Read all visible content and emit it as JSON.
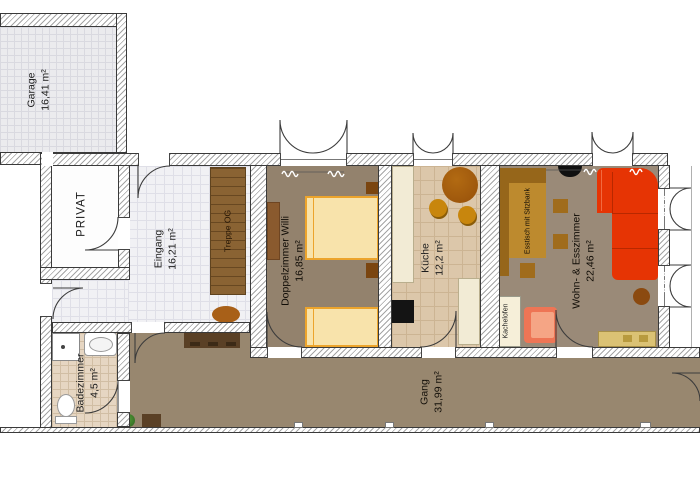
{
  "rooms": {
    "garage": {
      "name": "Garage",
      "area": "16,41 m²"
    },
    "privat": {
      "name": "PRIVAT",
      "area": ""
    },
    "eingang": {
      "name": "Eingang",
      "area": "16,21 m²"
    },
    "treppe_og": {
      "name": "Treppe OG",
      "area": ""
    },
    "doppelzimmer": {
      "name": "Doppelzimmer Willi",
      "area": "16,85 m²"
    },
    "kueche": {
      "name": "Küche",
      "area": "12,2 m²"
    },
    "wohn_esszimmer": {
      "name": "Wohn- & Esszimmer",
      "area": "22,46 m²"
    },
    "badezimmer": {
      "name": "Badezimmer",
      "area": "4,5 m²"
    },
    "gang": {
      "name": "Gang",
      "area": "31,99 m²"
    }
  },
  "furniture_labels": {
    "esstisch": "Esstisch mit Sitzbank",
    "kachelofen": "Kachelofen"
  },
  "colors": {
    "wall_hatch": "#a5a5a5",
    "wall_outline": "#3a3a3a",
    "floor_taupe": "#97876f",
    "floor_tile_white": "#f1f1f4",
    "floor_tile_beige": "#e6d6c2",
    "floor_tile_kitchen": "#dcc7aa",
    "sofa_red": "#e63404",
    "armchair_salmon": "#ee7555",
    "bed_cream": "#f8e3ab",
    "bed_frame_orange": "#eca42c",
    "wood_dark": "#5a4025",
    "wood_stair": "#8a6333",
    "bench_brown": "#96661a",
    "table_brown": "#bd8a2e",
    "sideboard_tan": "#dbc274",
    "kachelofen_cream": "#f6efd9",
    "plant_green": "#3e7d2a"
  }
}
